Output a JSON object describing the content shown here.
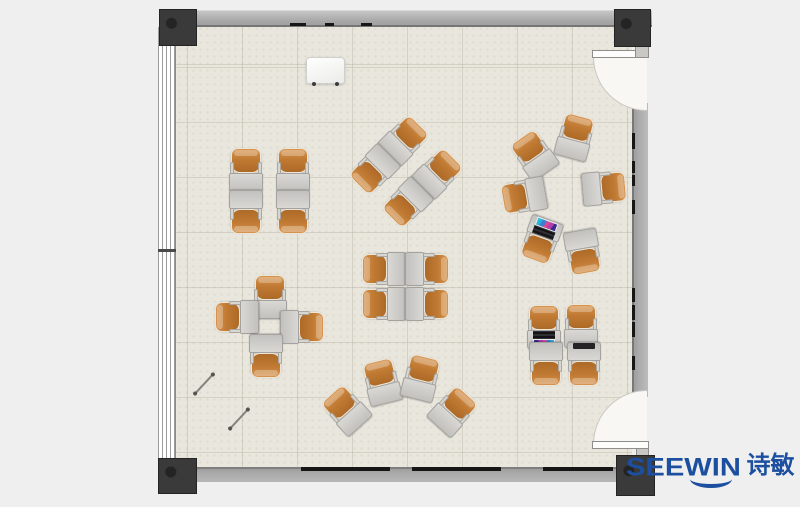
{
  "page": {
    "width": 800,
    "height": 507,
    "background": "#efeff0"
  },
  "logo": {
    "brand": "SEEWIN",
    "chinese": "诗敏",
    "color": "#1c4f9f"
  },
  "palette": {
    "floor": "#e9e6dd",
    "wall": "#a8a8a8",
    "column": "#3a3a3a",
    "chair_orange": "#c07a33",
    "desk_grey": "#cbcac7",
    "brand_blue": "#1c4f9f"
  },
  "room": {
    "floor": {
      "x": 176,
      "y": 25,
      "w": 456,
      "h": 443,
      "tile_size": 55
    },
    "walls": [
      {
        "side": "top",
        "x": 168,
        "y": 10,
        "w": 484,
        "h": 17
      },
      {
        "side": "bottom",
        "x": 160,
        "y": 467,
        "w": 457,
        "h": 15
      },
      {
        "side": "right",
        "x": 632,
        "y": 103,
        "w": 16,
        "h": 294
      }
    ],
    "window": {
      "side": "left",
      "x": 158,
      "y": 27,
      "w": 18,
      "h": 440,
      "mullion_tick_y": 249
    },
    "columns": [
      {
        "pos": "top-left",
        "x": 159,
        "y": 9,
        "w": 38,
        "h": 37
      },
      {
        "pos": "top-right",
        "x": 614,
        "y": 9,
        "w": 37,
        "h": 38
      },
      {
        "pos": "bottom-left",
        "x": 158,
        "y": 458,
        "w": 39,
        "h": 36
      },
      {
        "pos": "bottom-right",
        "x": 616,
        "y": 455,
        "w": 39,
        "h": 41
      }
    ],
    "doors": [
      {
        "pos": "top-right",
        "leaf": {
          "x": 592,
          "y": 50,
          "w": 57,
          "h": 8
        },
        "swing": {
          "x": 593,
          "y": 57,
          "w": 54,
          "h": 54,
          "corner": "bl"
        },
        "stub": {
          "x": 635,
          "y": 46,
          "w": 14,
          "h": 12
        }
      },
      {
        "pos": "bottom-right",
        "leaf": {
          "x": 592,
          "y": 441,
          "w": 57,
          "h": 8
        },
        "swing": {
          "x": 593,
          "y": 390,
          "w": 54,
          "h": 54,
          "corner": "tl"
        },
        "stub": {
          "x": 636,
          "y": 448,
          "w": 13,
          "h": 10
        }
      }
    ],
    "trim_marks": [
      {
        "x": 290,
        "y": 23,
        "w": 16,
        "h": 3
      },
      {
        "x": 325,
        "y": 23,
        "w": 9,
        "h": 3
      },
      {
        "x": 361,
        "y": 23,
        "w": 11,
        "h": 3
      },
      {
        "x": 301,
        "y": 467,
        "w": 89,
        "h": 4
      },
      {
        "x": 412,
        "y": 467,
        "w": 89,
        "h": 4
      },
      {
        "x": 543,
        "y": 467,
        "w": 70,
        "h": 4
      },
      {
        "x": 632,
        "y": 133,
        "w": 3,
        "h": 16
      },
      {
        "x": 632,
        "y": 161,
        "w": 3,
        "h": 12
      },
      {
        "x": 632,
        "y": 175,
        "w": 3,
        "h": 11
      },
      {
        "x": 632,
        "y": 200,
        "w": 3,
        "h": 14
      },
      {
        "x": 632,
        "y": 288,
        "w": 3,
        "h": 14
      },
      {
        "x": 632,
        "y": 305,
        "w": 3,
        "h": 15
      },
      {
        "x": 632,
        "y": 322,
        "w": 3,
        "h": 15
      },
      {
        "x": 632,
        "y": 356,
        "w": 3,
        "h": 14
      }
    ]
  },
  "furniture": {
    "unit_size": {
      "w": 34,
      "h": 44
    },
    "clusters": [
      {
        "name": "quad-top-left",
        "units": [
          {
            "x": 246,
            "y": 170,
            "rot": 0
          },
          {
            "x": 293,
            "y": 170,
            "rot": 0
          },
          {
            "x": 246,
            "y": 212,
            "rot": 180
          },
          {
            "x": 293,
            "y": 212,
            "rot": 180
          }
        ]
      },
      {
        "name": "quad-diagonal",
        "units": [
          {
            "x": 404,
            "y": 140,
            "rot": 45
          },
          {
            "x": 438,
            "y": 173,
            "rot": 45
          },
          {
            "x": 374,
            "y": 170,
            "rot": 225
          },
          {
            "x": 407,
            "y": 203,
            "rot": 225
          }
        ]
      },
      {
        "name": "circle-of-six",
        "units": [
          {
            "x": 575,
            "y": 137,
            "rot": 15
          },
          {
            "x": 534,
            "y": 155,
            "rot": -35
          },
          {
            "x": 524,
            "y": 196,
            "rot": -100
          },
          {
            "x": 604,
            "y": 188,
            "rot": 85
          },
          {
            "x": 541,
            "y": 240,
            "rot": 200,
            "prop": "laptop"
          },
          {
            "x": 583,
            "y": 252,
            "rot": 170
          }
        ]
      },
      {
        "name": "pinwheel-left",
        "units": [
          {
            "x": 270,
            "y": 297,
            "rot": 0
          },
          {
            "x": 237,
            "y": 317,
            "rot": -90
          },
          {
            "x": 302,
            "y": 327,
            "rot": 90
          },
          {
            "x": 266,
            "y": 356,
            "rot": 180
          }
        ]
      },
      {
        "name": "quad-center",
        "units": [
          {
            "x": 384,
            "y": 269,
            "rot": -90
          },
          {
            "x": 427,
            "y": 269,
            "rot": 90
          },
          {
            "x": 384,
            "y": 304,
            "rot": -90
          },
          {
            "x": 427,
            "y": 304,
            "rot": 90
          }
        ]
      },
      {
        "name": "fan-bottom",
        "units": [
          {
            "x": 346,
            "y": 410,
            "rot": -42
          },
          {
            "x": 382,
            "y": 382,
            "rot": -14
          },
          {
            "x": 421,
            "y": 378,
            "rot": 14
          },
          {
            "x": 453,
            "y": 411,
            "rot": 42
          }
        ]
      },
      {
        "name": "quad-bottom-right",
        "units": [
          {
            "x": 544,
            "y": 327,
            "rot": 0,
            "prop": "laptop"
          },
          {
            "x": 581,
            "y": 326,
            "rot": 0
          },
          {
            "x": 546,
            "y": 364,
            "rot": 180
          },
          {
            "x": 584,
            "y": 364,
            "rot": 180,
            "prop": "tablet"
          }
        ]
      }
    ]
  },
  "props": {
    "whiteboard": {
      "x": 306,
      "y": 57,
      "w": 39,
      "h": 27
    },
    "sticks": [
      {
        "cx": 204,
        "cy": 384,
        "len": 26,
        "rot": -47
      },
      {
        "cx": 239,
        "cy": 419,
        "len": 26,
        "rot": -47
      }
    ]
  }
}
